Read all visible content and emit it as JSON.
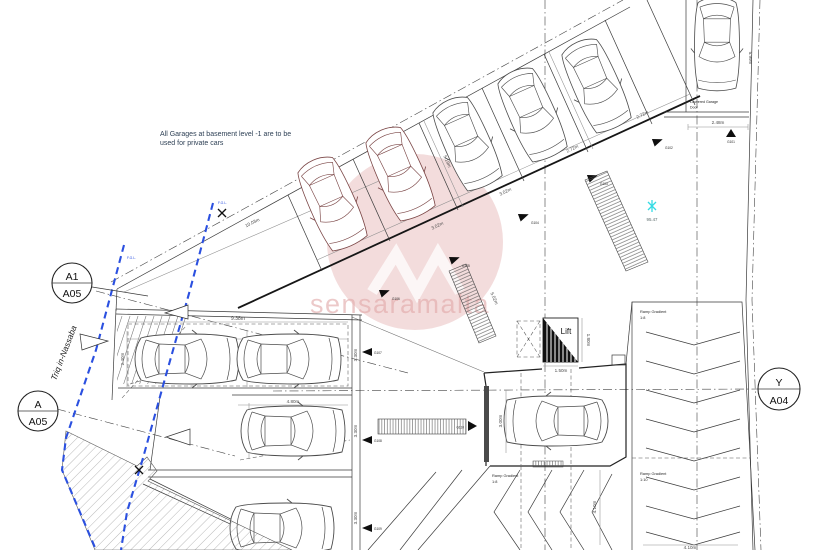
{
  "note": {
    "line1": "All Garages at basement level -1 are to be",
    "line2": "used for private cars"
  },
  "street_name": "Triq in-Nassaba",
  "watermark": {
    "text": "sensaramalta"
  },
  "section_markers": {
    "a1": {
      "top": "A1",
      "bottom": "A05"
    },
    "a": {
      "top": "A",
      "bottom": "A05"
    },
    "y": {
      "top": "Y",
      "bottom": "A04"
    }
  },
  "spot_level": {
    "value": "95.47"
  },
  "boundary": {
    "fgl_a": "F.G.L.",
    "fgl_b": "F.G.L."
  },
  "lift": {
    "label": "Lift",
    "width": "1.50m",
    "depth": "1.80m"
  },
  "louvered_door": {
    "line1": "Louvered Garage",
    "line2": "Door"
  },
  "ramps": {
    "right_upper": {
      "label": "Ramp Gradient",
      "ratio": "1:8"
    },
    "right_lower": {
      "label": "Ramp Gradient",
      "ratio": "1:10"
    },
    "center": {
      "label": "Ramp Gradient",
      "ratio": "1:8"
    },
    "bottom_width": "4.10m",
    "side_depth": "4.10m"
  },
  "garage_doors": [
    "G101",
    "G102",
    "G103",
    "G104",
    "G105",
    "G106",
    "G107",
    "G108",
    "G109",
    "G110"
  ],
  "dimensions": {
    "street_frontage": "10.03m",
    "stall_depth_a": "5.19m",
    "stall_depth_b": "5.19m",
    "stall_w1": "2.72m",
    "stall_w2": "2.72m",
    "stall_w3": "3.02m",
    "stall_w4": "3.02m",
    "corner_bay_depth": "5.99m",
    "corner_bay_width": "2.48m",
    "block_total": "9.38m",
    "bay1a": "4.80m",
    "bay1b": "4.80m",
    "bay2": "4.80m",
    "car1a": "2.40m",
    "car1b": "2.40m",
    "car2": "2.40m",
    "depth1": "3.30m",
    "depth2": "3.30m",
    "depth3": "3.30m",
    "entry_bay": "3.00m",
    "door_strip": "5.02m"
  }
}
